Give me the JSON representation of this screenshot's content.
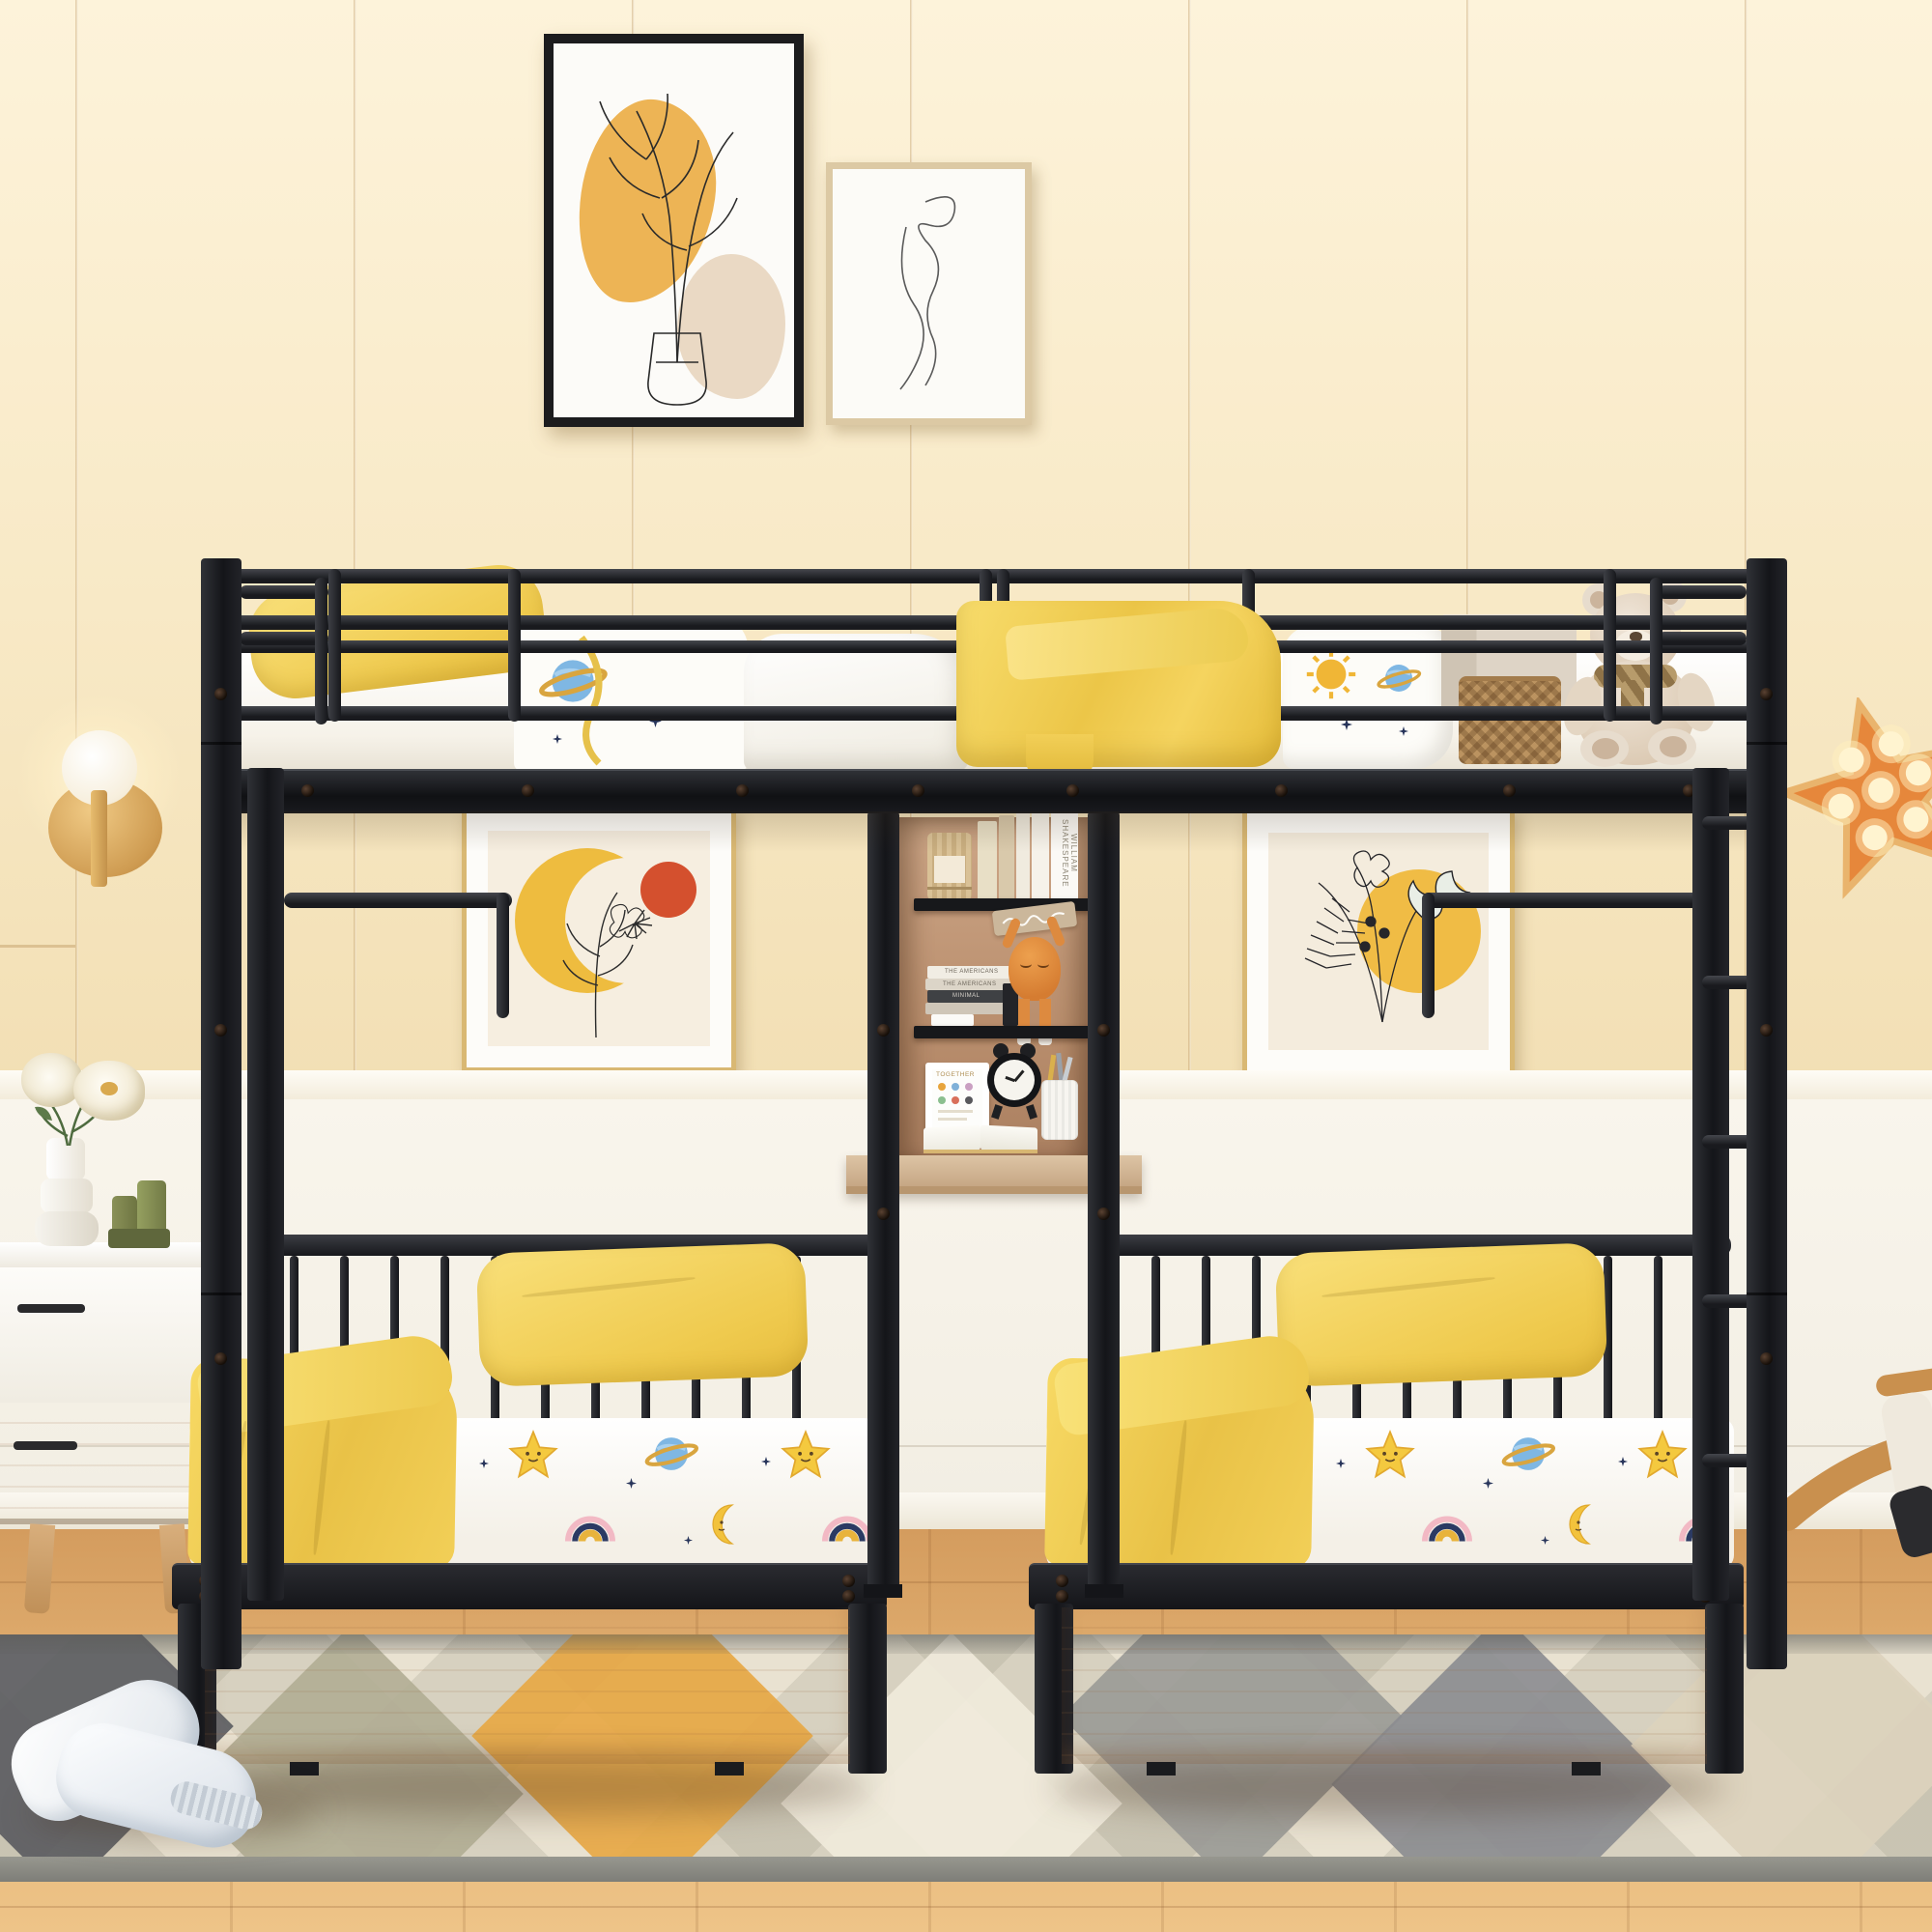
{
  "scene": {
    "description": "Kids bedroom product photo: black metal triple bunk bed (full-size top bunk over two twin beds with storage drawers) joined by a central shelf and desk tower; yellow bedding with star, planet, moon and rainbow print; cream plank wall with line-art posters; white nightstand with flowers; gold sconce; orange star marquee lamp; geometric diamond rug; white plush slippers; wooden rocking toy",
    "texts": {
      "book_spine_shakespeare": "WILLIAM SHAKESPEARE",
      "stacked_book_1": "THE AMERICANS",
      "stacked_book_2": "THE AMERICANS",
      "stacked_book_3": "MINIMAL",
      "photo_frame_caption": "TOGETHER"
    },
    "palette": {
      "wall_cream": "#f8ebc9",
      "wainscot_white": "#f6f2e9",
      "floor_wood": "#dda667",
      "metal_black": "#1d1e22",
      "bedding_yellow": "#f5d45f",
      "drawer_wood": "#e4c0a0",
      "rug_beige": "#e9e2d1",
      "rug_orange": "#e8a743",
      "star_lamp_orange": "#e6873b",
      "poster_red_dot": "#d4502e",
      "print_blue_planet": "#7fb7e3",
      "gold_frame": "#d9b873"
    }
  }
}
